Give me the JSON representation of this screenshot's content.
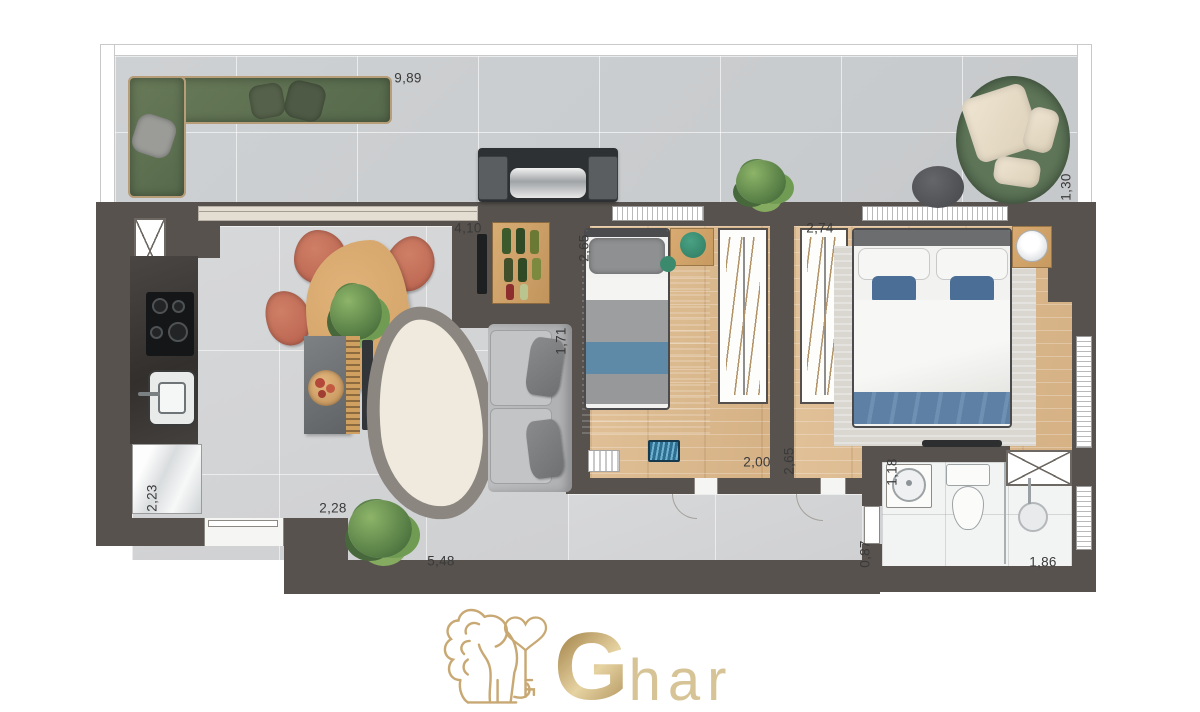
{
  "page": {
    "background_color": "#ffffff"
  },
  "branding": {
    "logo_main_letter": "G",
    "logo_rest": "har",
    "lion_icon": "lion-holding-heart-key",
    "gold_dark": "#ae8f57",
    "gold_light": "#dcc99c"
  },
  "floorplan": {
    "colors": {
      "wall": "#57524e",
      "balcony_tile": "#cbced0",
      "interior_tile": "#d4d5d7",
      "wood_floor": "#dcba90",
      "bathroom_tile": "#f2f3f3",
      "green_sofa": "#617353",
      "terracotta_chair": "#c4705c",
      "blue_bedding": "#5d80a4"
    },
    "dimensions": [
      {
        "id": "balcony-length",
        "label": "9,89",
        "orientation": "horizontal"
      },
      {
        "id": "living-width",
        "label": "4,10",
        "orientation": "horizontal"
      },
      {
        "id": "bedroom1-width",
        "label": "2,65",
        "orientation": "vertical"
      },
      {
        "id": "bedroom2-width",
        "label": "2,74",
        "orientation": "horizontal"
      },
      {
        "id": "balcony-depth",
        "label": "1,30",
        "orientation": "vertical"
      },
      {
        "id": "sofa-wall-length",
        "label": "1,71",
        "orientation": "vertical"
      },
      {
        "id": "kitchen-depth",
        "label": "2,23",
        "orientation": "vertical"
      },
      {
        "id": "kitchen-width",
        "label": "2,28",
        "orientation": "horizontal"
      },
      {
        "id": "living-length",
        "label": "5,48",
        "orientation": "horizontal"
      },
      {
        "id": "bedroom1-length",
        "label": "2,00",
        "orientation": "horizontal"
      },
      {
        "id": "hall-depth",
        "label": "2,65",
        "orientation": "vertical"
      },
      {
        "id": "bath-vanity-width",
        "label": "1,18",
        "orientation": "vertical"
      },
      {
        "id": "bath-entry-width",
        "label": "0,87",
        "orientation": "vertical"
      },
      {
        "id": "shower-width",
        "label": "1,86",
        "orientation": "horizontal"
      }
    ]
  }
}
